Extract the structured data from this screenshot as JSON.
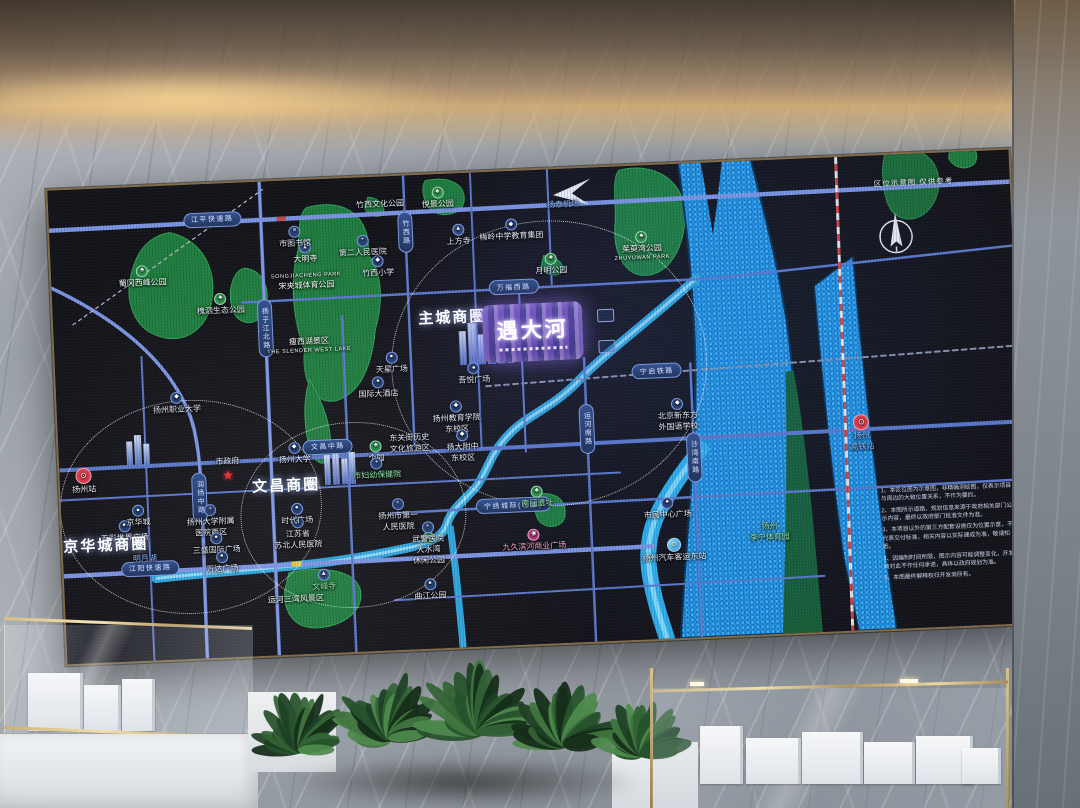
{
  "map": {
    "corner_note": "区位示意图 仅供参考",
    "project": {
      "name": "遇大河"
    },
    "business_circles": [
      "主城商圈",
      "文昌商圈",
      "京华城商圈"
    ],
    "road_pills": [
      {
        "n": "jiangping-expressway",
        "x": 17,
        "y": 7.5,
        "t": "江平快速路"
      },
      {
        "n": "wanfu-west-road",
        "x": 48,
        "y": 24.5,
        "t": "万福西路"
      },
      {
        "n": "wenchang-middle-road",
        "x": 28,
        "y": 56.5,
        "t": "文昌中路"
      },
      {
        "n": "jiangyang-expressway",
        "x": 9,
        "y": 80.5,
        "t": "江阳快速路"
      },
      {
        "n": "ningyang-intercity-rail",
        "x": 47,
        "y": 70.5,
        "t": "宁扬城际(在建)"
      },
      {
        "n": "ningqi-railway",
        "x": 62.5,
        "y": 43.5,
        "t": "宁启铁路"
      },
      {
        "n": "yangzijiang-north-road",
        "x": 22,
        "y": 31,
        "t": "扬子江北路",
        "v": 1
      },
      {
        "n": "zhuxi-road",
        "x": 37,
        "y": 12,
        "t": "竹西路",
        "v": 1
      },
      {
        "n": "runyang-middle-road",
        "x": 14.5,
        "y": 66,
        "t": "润扬中路",
        "v": 1
      },
      {
        "n": "yunhe-south-road",
        "x": 55,
        "y": 55,
        "t": "运河南路",
        "v": 1
      },
      {
        "n": "shawan-south-road",
        "x": 66,
        "y": 62,
        "t": "沙湾南路",
        "v": 1
      }
    ],
    "circles": [
      {
        "n": "circle-zhucheng",
        "cx": 51.3,
        "cy": 41,
        "rx": 157,
        "ry": 142
      },
      {
        "n": "circle-wenchang",
        "cx": 30.4,
        "cy": 71,
        "rx": 112,
        "ry": 92
      },
      {
        "n": "circle-jinghuacheng",
        "cx": 13.5,
        "cy": 68,
        "rx": 130,
        "ry": 106
      }
    ],
    "pois": [
      {
        "n": "biz-zhucheng",
        "x": 41.5,
        "y": 30.5,
        "lines": [
          "主城商圈"
        ],
        "cls": "biz"
      },
      {
        "n": "biz-wenchang",
        "x": 23.5,
        "y": 64.5,
        "lines": [
          "文昌商圈"
        ],
        "cls": "biz"
      },
      {
        "n": "biz-jinghuacheng",
        "x": 4.5,
        "y": 75.5,
        "lines": [
          "京华城商圈"
        ],
        "cls": "biz"
      },
      {
        "n": "shugang-west-park",
        "i": "park",
        "x": 9.5,
        "y": 19,
        "lines": [
          "蜀冈西峰公园"
        ],
        "cls": "on-green"
      },
      {
        "n": "huaisi-eco-park",
        "i": "park",
        "x": 17.5,
        "y": 25.5,
        "lines": [
          "槐泗生态公园"
        ]
      },
      {
        "n": "songjiacheng-park",
        "x": 26.5,
        "y": 21.5,
        "lines": [
          "SONGJIACHENG PARK",
          "宋夹城体育公园"
        ],
        "cls": "on-green"
      },
      {
        "n": "slender-west-lake",
        "x": 26.5,
        "y": 35,
        "lines": [
          "瘦西湖景区",
          "THE SLENDER WEST LAKE"
        ],
        "cls": "on-green"
      },
      {
        "n": "yuejing-park",
        "i": "park",
        "x": 40.5,
        "y": 5,
        "lines": [
          "悦景公园"
        ],
        "cls": "on-green"
      },
      {
        "n": "yueming-park",
        "i": "park",
        "x": 52,
        "y": 20,
        "lines": [
          "月明公园"
        ]
      },
      {
        "n": "zhuyuwan-park",
        "i": "park",
        "x": 61.5,
        "y": 17,
        "lines": [
          "茱萸湾公园",
          "ZHUYUWAN PARK"
        ],
        "cls": "on-green"
      },
      {
        "n": "sanwan-scenic-area",
        "x": 24,
        "y": 88.5,
        "lines": [
          "运河三湾风景区"
        ],
        "cls": "on-green"
      },
      {
        "n": "zhuxi-culture-park",
        "x": 34.5,
        "y": 6,
        "lines": [
          "竹西文化公园"
        ]
      },
      {
        "n": "dashuiwan-park",
        "i": "park",
        "x": 38,
        "y": 79,
        "lines": [
          "大水湾",
          "休闲公园"
        ]
      },
      {
        "n": "daming-temple",
        "i": "temple",
        "x": 26.5,
        "y": 15.5,
        "lines": [
          "大明寺"
        ],
        "cls": "on-green"
      },
      {
        "n": "shangfang-temple",
        "i": "temple",
        "x": 42.5,
        "y": 13,
        "lines": [
          "上方寺"
        ]
      },
      {
        "n": "wenfeng-temple",
        "i": "temple",
        "x": 27,
        "y": 84.5,
        "lines": [
          "文峰寺"
        ],
        "cls": "green-text"
      },
      {
        "n": "nanmen-site",
        "i": "park",
        "x": 49.5,
        "y": 69,
        "lines": [
          "南门遗址"
        ],
        "cls": "green-text"
      },
      {
        "n": "geyuan-garden",
        "i": "park",
        "x": 33,
        "y": 58,
        "lines": [
          "个园"
        ]
      },
      {
        "n": "dongguan-street",
        "x": 36.5,
        "y": 56.5,
        "lines": [
          "东关街历史",
          "文化旅游区"
        ]
      },
      {
        "n": "yangzhou-polytechnic",
        "i": "school",
        "x": 12.5,
        "y": 46,
        "lines": [
          "扬州职业大学"
        ]
      },
      {
        "n": "yangzhou-university",
        "i": "school",
        "x": 24.5,
        "y": 57.5,
        "lines": [
          "扬州大学"
        ]
      },
      {
        "n": "meiling-school",
        "i": "school",
        "x": 48,
        "y": 12.5,
        "lines": [
          "梅岭中学教育集团"
        ]
      },
      {
        "n": "yangzhou-edu-college",
        "i": "school",
        "x": 41.5,
        "y": 51.5,
        "lines": [
          "扬州教育学院",
          "东校区"
        ]
      },
      {
        "n": "yangda-fuzhong",
        "i": "school",
        "x": 42,
        "y": 57.5,
        "lines": [
          "扬大附中",
          "东校区"
        ]
      },
      {
        "n": "new-oriental-school",
        "i": "school",
        "x": 64.5,
        "y": 53,
        "lines": [
          "北京新东方",
          "外国语学校"
        ]
      },
      {
        "n": "zhuxi-primary-school",
        "i": "school",
        "x": 34,
        "y": 19,
        "lines": [
          "竹西小学"
        ]
      },
      {
        "n": "city-library",
        "i": "lib",
        "x": 25.5,
        "y": 12,
        "lines": [
          "市图书馆"
        ]
      },
      {
        "n": "second-peoples-hospital",
        "i": "hosp",
        "x": 32.5,
        "y": 14.5,
        "lines": [
          "第二人民医院"
        ]
      },
      {
        "n": "yangda-affiliated-hospital",
        "i": "hosp",
        "x": 15.5,
        "y": 71,
        "lines": [
          "扬州大学附属",
          "医院西区"
        ]
      },
      {
        "n": "subei-peoples-hospital",
        "i": "hosp",
        "x": 24.5,
        "y": 74.5,
        "lines": [
          "江苏省",
          "苏北人民医院"
        ]
      },
      {
        "n": "first-peoples-hospital",
        "i": "hosp",
        "x": 35,
        "y": 71.5,
        "lines": [
          "扬州市第一",
          "人民医院"
        ]
      },
      {
        "n": "maternity-hospital",
        "i": "hosp",
        "x": 33,
        "y": 61.5,
        "lines": [
          "市妇幼保健院"
        ],
        "cls": "green-text"
      },
      {
        "n": "wujing-hospital",
        "i": "hosp",
        "x": 38,
        "y": 75.5,
        "lines": [
          "武警医院"
        ]
      },
      {
        "n": "times-square",
        "i": "mall",
        "x": 24.5,
        "y": 70.5,
        "lines": [
          "时代广场"
        ]
      },
      {
        "n": "sansheng-intl-plaza",
        "i": "mall",
        "x": 16,
        "y": 76,
        "lines": [
          "三盛国际广场"
        ]
      },
      {
        "n": "wanda-plaza",
        "i": "mall",
        "x": 16.5,
        "y": 80,
        "lines": [
          "万达广场"
        ]
      },
      {
        "n": "wucai-world-plaza",
        "i": "mall",
        "x": 6.5,
        "y": 72.5,
        "lines": [
          "五彩世界广场"
        ]
      },
      {
        "n": "jinghuacheng-mall",
        "i": "mall",
        "x": 8,
        "y": 69.5,
        "lines": [
          "京华城"
        ]
      },
      {
        "n": "mingyue-lake",
        "x": 8.5,
        "y": 78.5,
        "lines": [
          "明月湖"
        ],
        "cls": "blue-text"
      },
      {
        "n": "jiujiu-binhe-plaza",
        "i": "pink",
        "x": 49,
        "y": 78,
        "lines": [
          "九久滨河商业广场"
        ],
        "cls": "pink-text"
      },
      {
        "n": "qujiang-park",
        "i": "mall",
        "x": 38,
        "y": 87.5,
        "lines": [
          "曲江公园"
        ]
      },
      {
        "n": "wuyue-plaza",
        "i": "mall",
        "x": 43.5,
        "y": 42.5,
        "lines": [
          "吾悦广场"
        ]
      },
      {
        "n": "tianxing-plaza",
        "i": "mall",
        "x": 35,
        "y": 39.5,
        "lines": [
          "天星广场"
        ]
      },
      {
        "n": "international-hotel",
        "i": "mall",
        "x": 33.5,
        "y": 44.5,
        "lines": [
          "国际大酒店"
        ]
      },
      {
        "n": "civic-center-plaza",
        "i": "mall",
        "x": 63,
        "y": 72.5,
        "lines": [
          "市民中心广场"
        ]
      },
      {
        "n": "bus-east-station",
        "i": "bus",
        "x": 63.5,
        "y": 81.5,
        "lines": [
          "扬州汽车客运东站"
        ]
      },
      {
        "n": "lining-sports-park",
        "x": 73.5,
        "y": 78.5,
        "lines": [
          "扬州",
          "李宁体育园"
        ],
        "cls": "green-text"
      },
      {
        "n": "yangzhou-station",
        "i": "train",
        "x": 2.5,
        "y": 61.5,
        "lines": [
          "扬州站"
        ]
      },
      {
        "n": "yangzhou-hsr-station",
        "i": "train",
        "x": 83.5,
        "y": 58.5,
        "lines": [
          "扬州",
          "高铁站"
        ],
        "cls": "blue-text"
      },
      {
        "n": "yangtai-airport",
        "x": 53.5,
        "y": 7.5,
        "lines": [
          "扬泰机场"
        ],
        "cls": "blue-text"
      },
      {
        "n": "city-government",
        "i": "star",
        "x": 17.5,
        "y": 60.5,
        "lines": [
          "市政府"
        ],
        "cls": "icon-below"
      }
    ],
    "disclaimer": [
      "1、本区位图为示意图，非精确测绘图，仅表示项目与周边的大致位置关系，不作为要约。",
      "2、本图所示道路、规划信息来源于政府相关部门公示内容，最终以政府部门批准文件为准。",
      "3、本项目以外的第三方配套设施仅为位置示意，不代表交付标准，相关内容以实际建成为准，敬请知悉。",
      "4、因编制时间所限，图示内容可能调整变化，开发商对此不作任何承诺，具体以政府规划为准。",
      "5、本图最终解释权归开发商所有。"
    ]
  }
}
